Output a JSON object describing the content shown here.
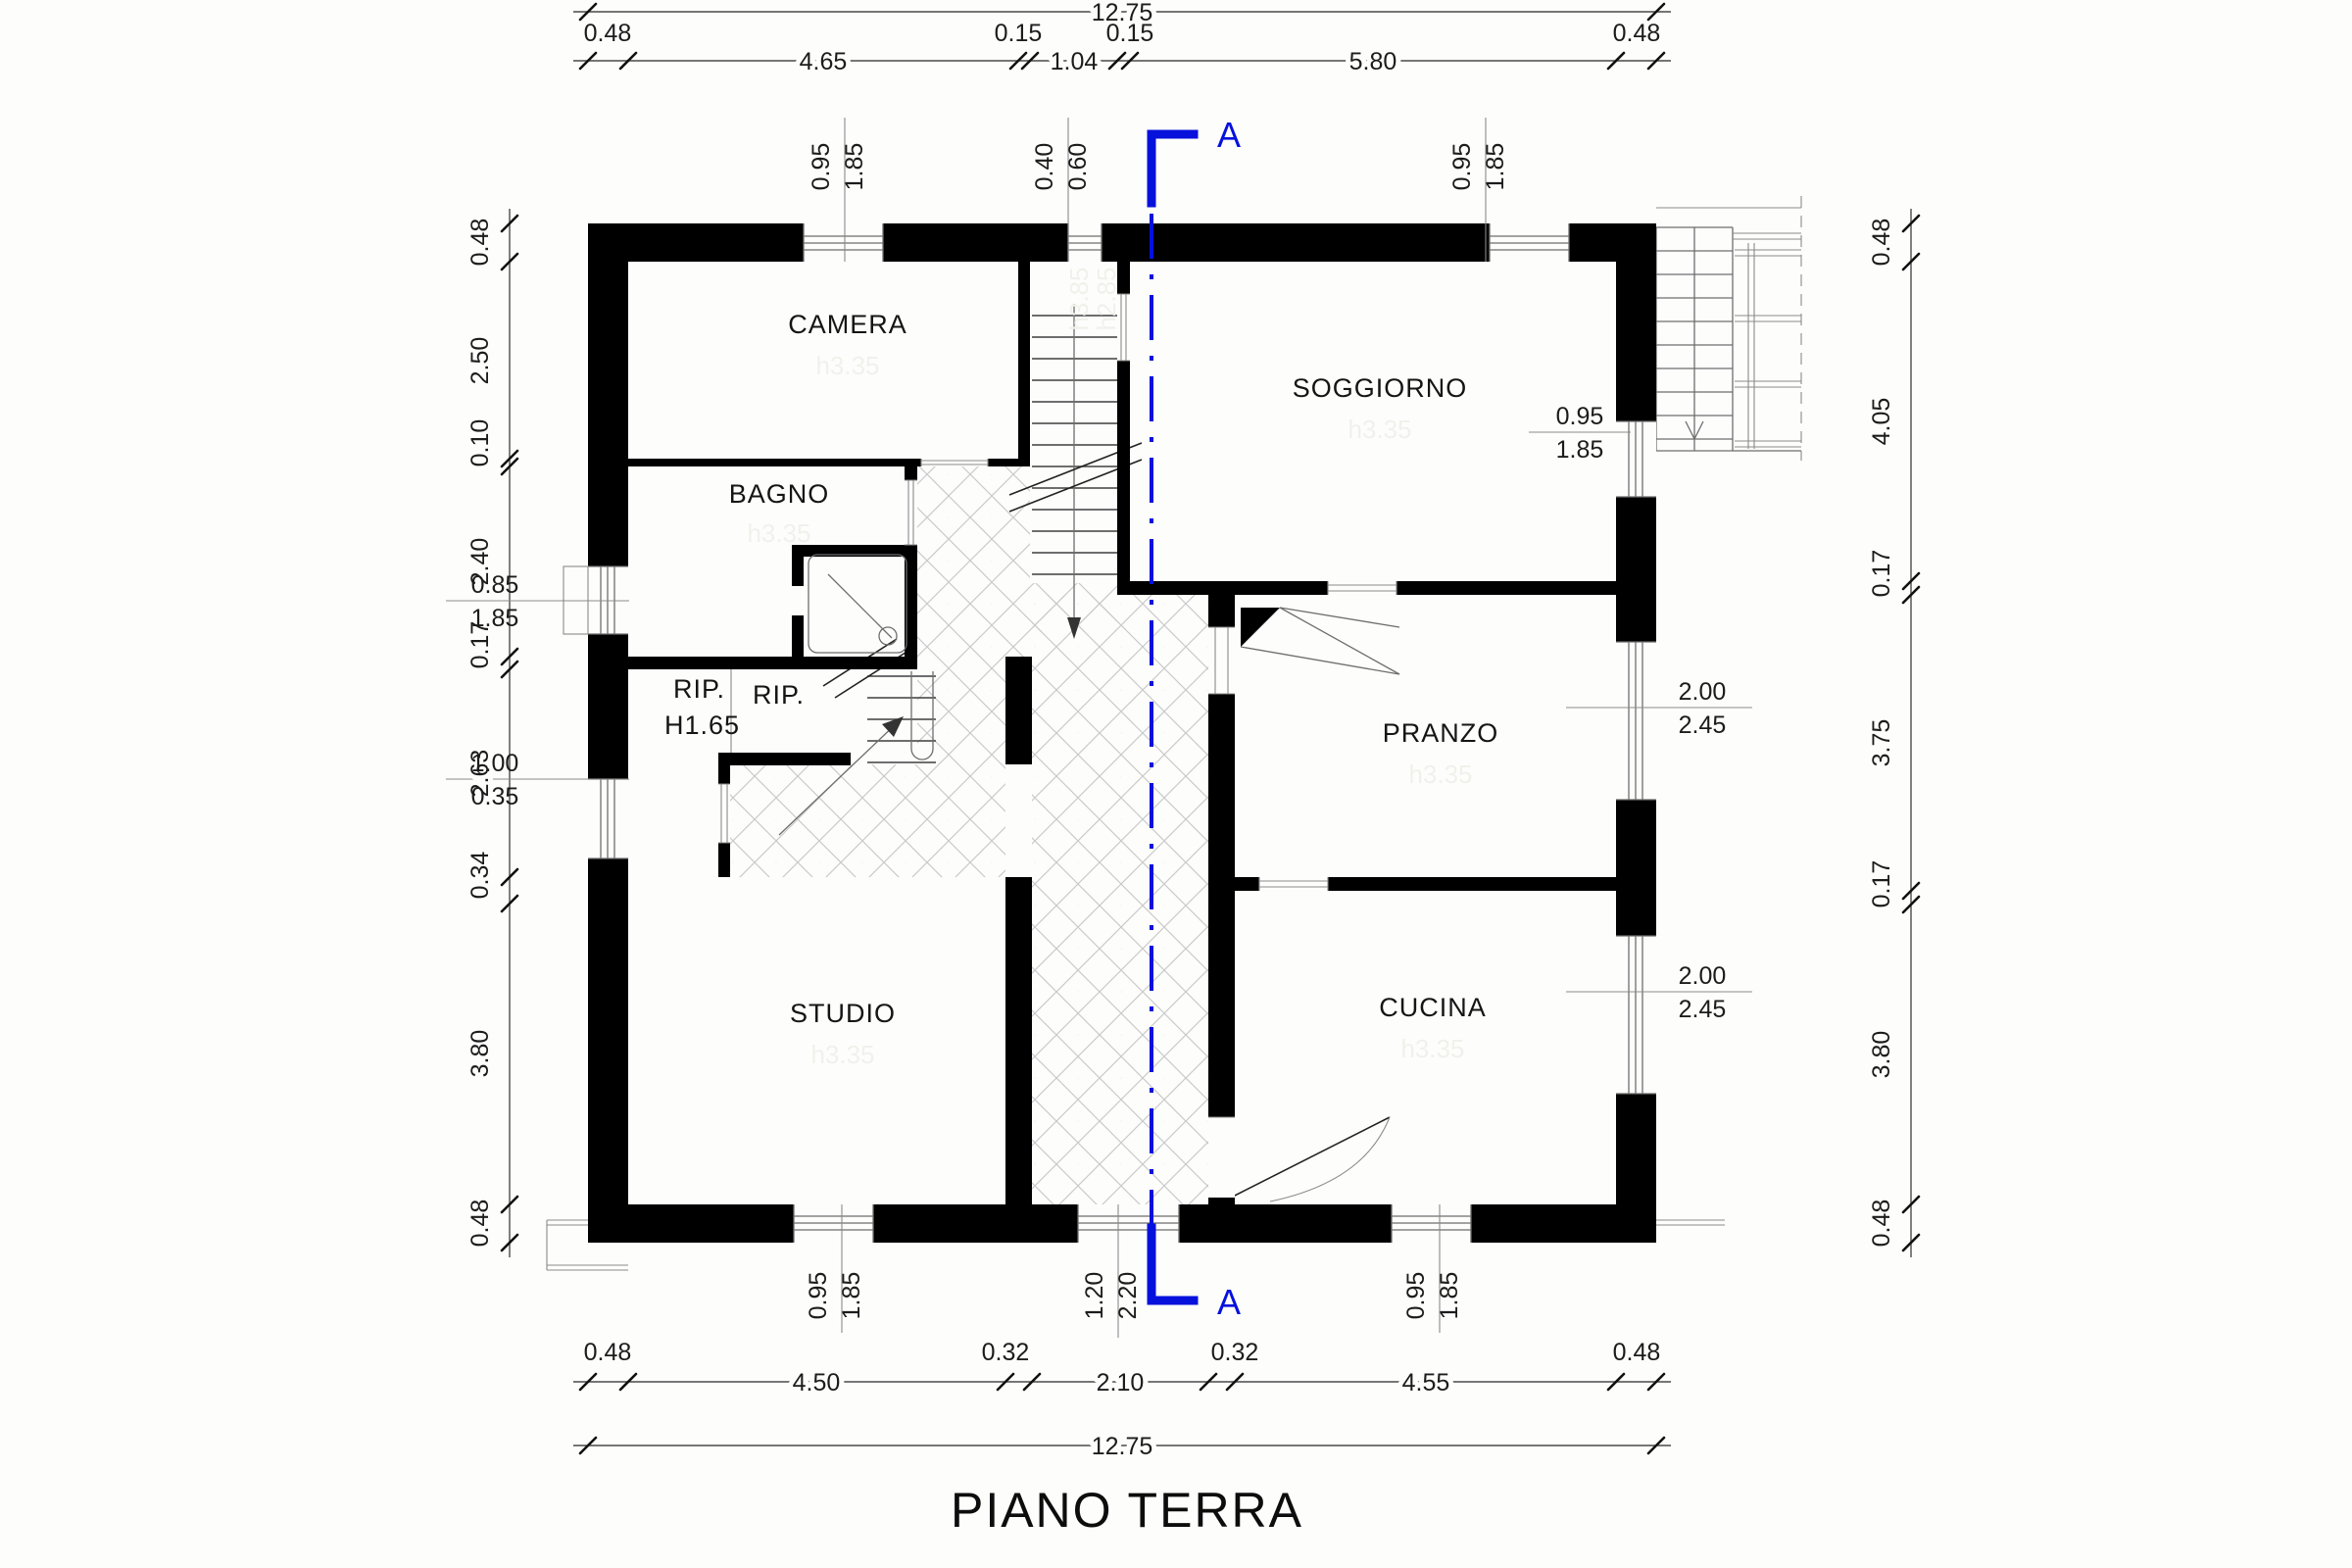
{
  "title": "PIANO TERRA",
  "section": {
    "label_top": "A",
    "label_bottom": "A"
  },
  "rooms": {
    "camera": {
      "label": "CAMERA",
      "note": "h3.35"
    },
    "bagno": {
      "label": "BAGNO",
      "note": "h3.35"
    },
    "soggiorno": {
      "label": "SOGGIORNO",
      "note": "h3.35"
    },
    "pranzo": {
      "label": "PRANZO",
      "note": "h3.35"
    },
    "cucina": {
      "label": "CUCINA",
      "note": "h3.35"
    },
    "studio": {
      "label": "STUDIO",
      "note": "h3.35"
    },
    "rip1": {
      "label": "RIP.",
      "sublabel": "H1.65"
    },
    "rip2": {
      "label": "RIP."
    },
    "vestibule_note_a": "h3.85",
    "vestibule_note_b": "h2.85"
  },
  "dims": {
    "top_total": "12.75",
    "bottom_total": "12.75",
    "top": {
      "d1": "0.48",
      "d2": "4.65",
      "d3": "0.15",
      "d4": "1.04",
      "d5": "0.15",
      "d6": "5.80",
      "d7": "0.48"
    },
    "bottom": {
      "d1": "0.48",
      "d2": "4.50",
      "d3": "0.32",
      "d4": "2.10",
      "d5": "0.32",
      "d6": "4.55",
      "d7": "0.48"
    },
    "left": {
      "d1": "0.48",
      "d2": "2.50",
      "d3": "0.10",
      "d4": "2.40",
      "d5": "0.17",
      "d6": "2.63",
      "d7": "0.34",
      "d8": "3.80",
      "d9": "0.48"
    },
    "right": {
      "d1": "0.48",
      "d2": "4.05",
      "d3": "0.17",
      "d4": "3.75",
      "d5": "0.17",
      "d6": "3.80",
      "d7": "0.48"
    },
    "openings": {
      "top_w1": {
        "w": "0.95",
        "h": "1.85"
      },
      "top_door": {
        "w": "0.40",
        "h": "0.60"
      },
      "top_w2": {
        "w": "0.95",
        "h": "1.85"
      },
      "right_sogg": {
        "w": "0.95",
        "h": "1.85"
      },
      "right_pranzo": {
        "w": "2.00",
        "h": "2.45"
      },
      "right_cucina": {
        "w": "2.00",
        "h": "2.45"
      },
      "left_bagno": {
        "w": "0.85",
        "h": "1.85"
      },
      "left_rip": {
        "w": "1.00",
        "h": "0.35"
      },
      "bottom_studio": {
        "w": "0.95",
        "h": "1.85"
      },
      "bottom_door": {
        "w": "1.20",
        "h": "2.20"
      },
      "bottom_cucina": {
        "w": "0.95",
        "h": "1.85"
      }
    }
  },
  "colors": {
    "section_line": "#0611dc",
    "walls": "#000000",
    "dim_lines": "#4a4a4a",
    "hatch": "#c9c9c9",
    "faint_note": "#f1f1ec"
  }
}
